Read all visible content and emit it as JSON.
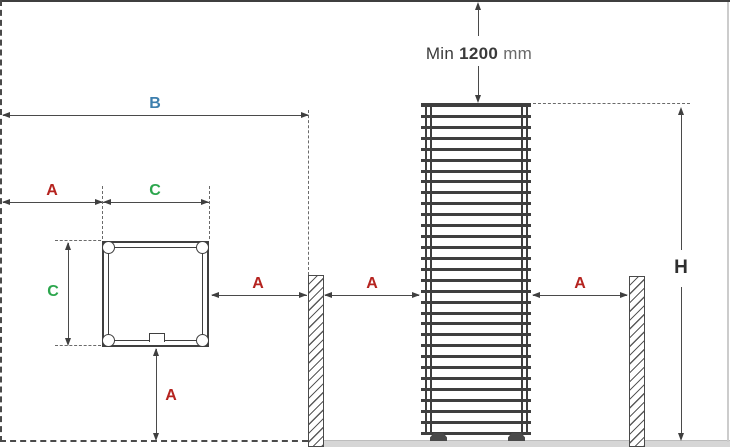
{
  "diagram": {
    "type": "heater-installation-clearance-diagram",
    "dimensions": {
      "a_label": "A",
      "b_label": "B",
      "c_label": "C",
      "h_label": "H",
      "min_clearance": {
        "prefix": "Min",
        "value": "1200",
        "unit": "mm"
      }
    },
    "colors": {
      "a": "#b5231f",
      "b": "#3d7fae",
      "c": "#2ca64d",
      "h": "#2f2f2f",
      "linework": "#3f3f3f",
      "floor": "#d6d6d6"
    },
    "heater": {
      "bar_count": 31
    }
  }
}
